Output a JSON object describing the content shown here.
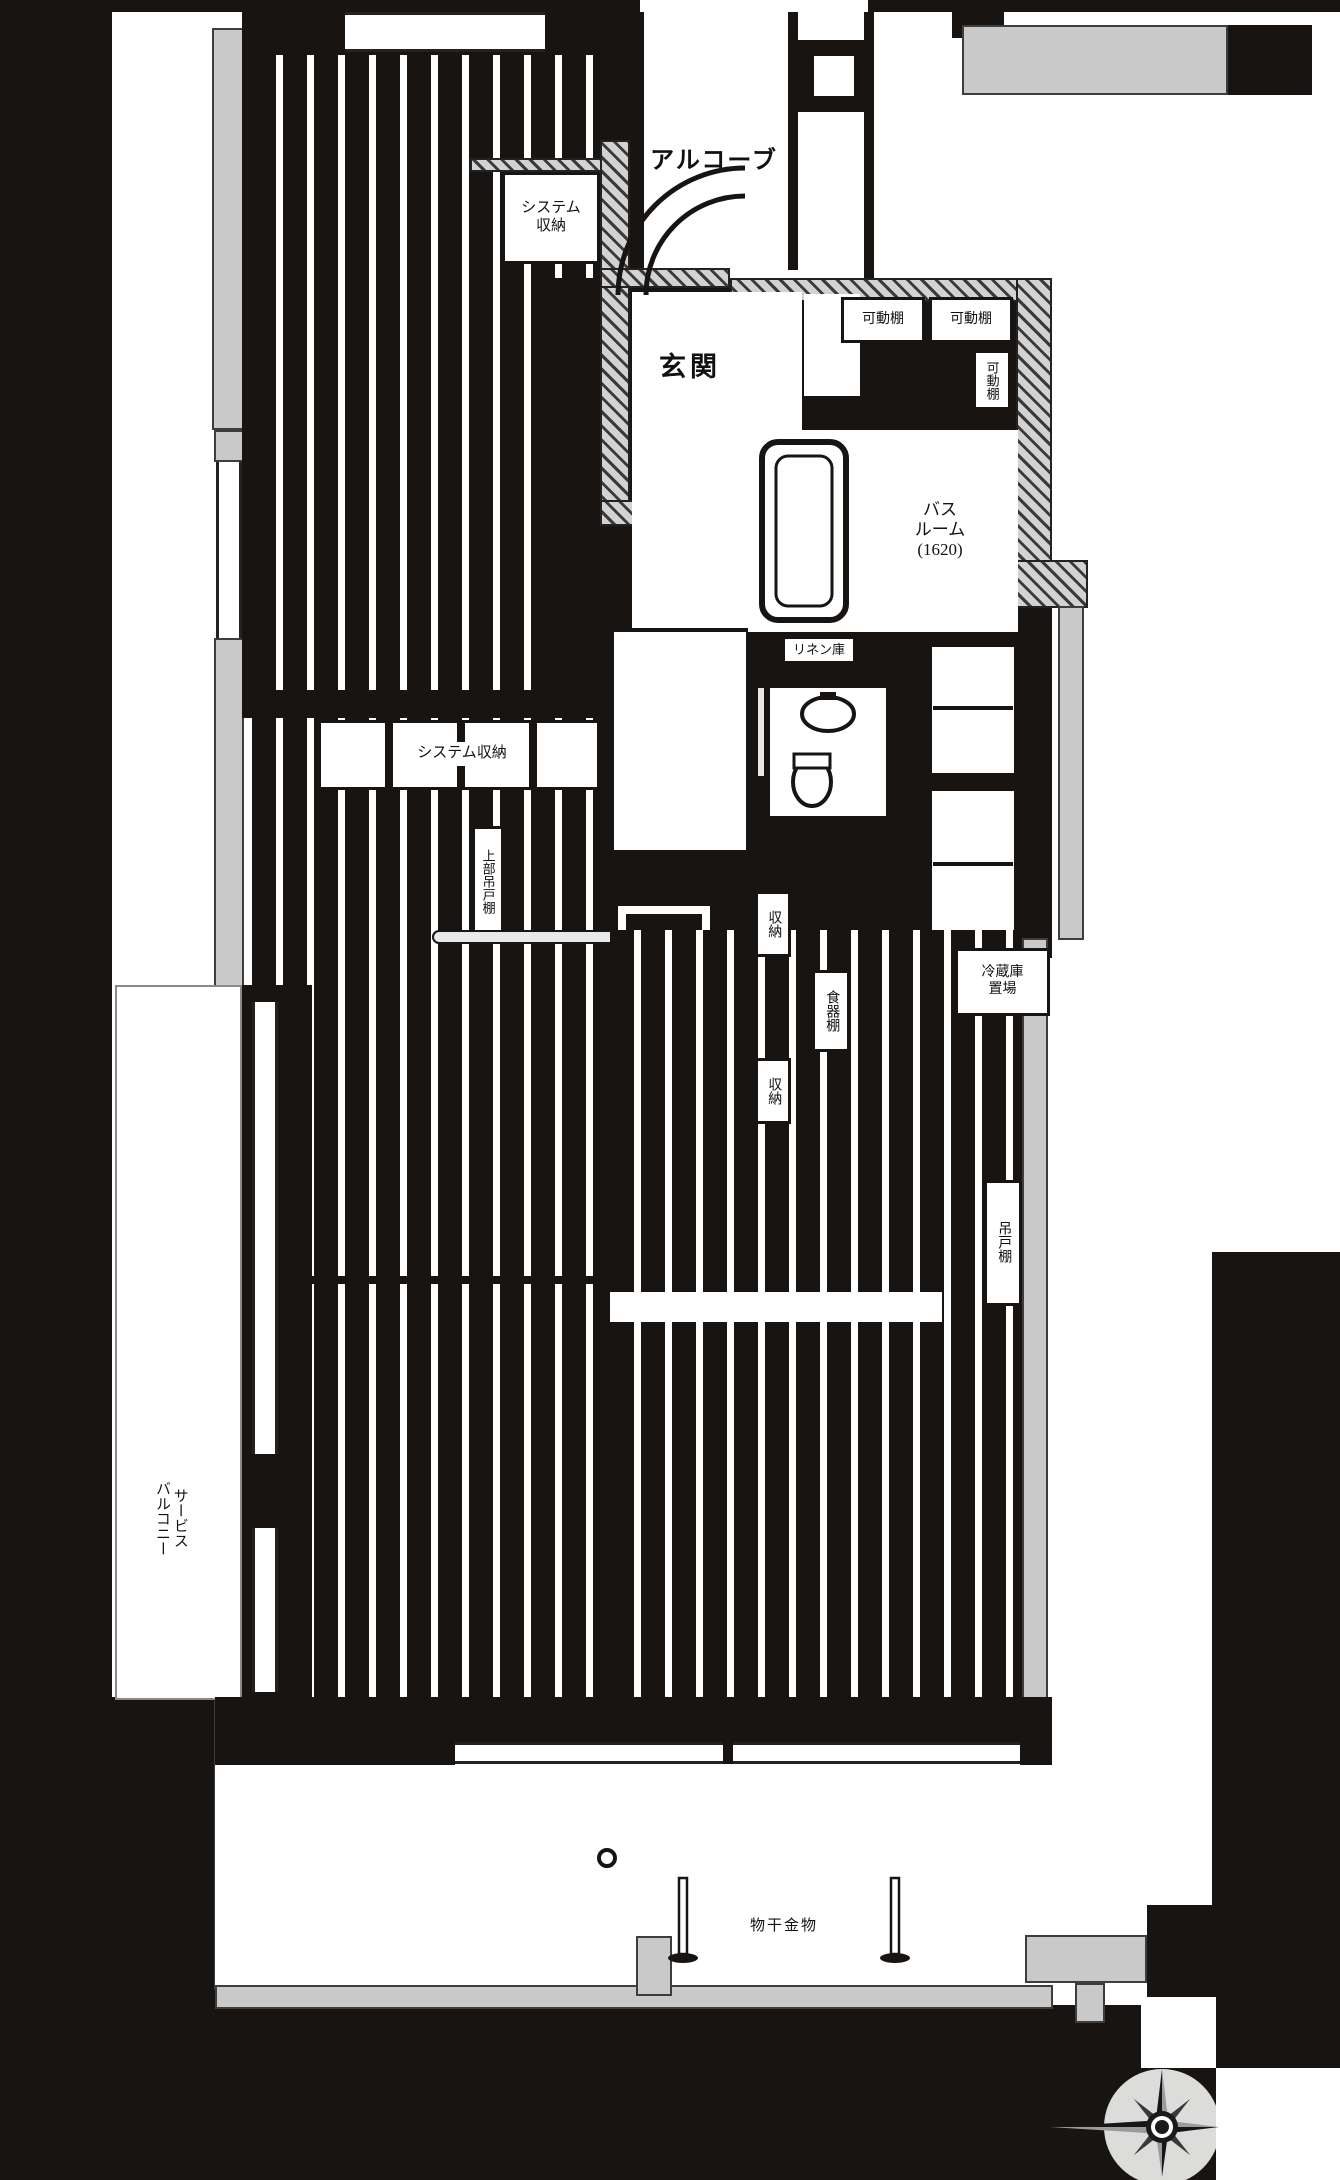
{
  "plan": {
    "type": "apartment-floor-plan",
    "colors": {
      "wall": "#181411",
      "slab_gray": "#c9c9c9",
      "floor_white": "#ffffff",
      "hatch_light": "#d2d2d2"
    },
    "labels": {
      "alcove": "アルコーブ",
      "system_storage_top": "システム\n収納",
      "entrance": "玄関",
      "movable_shelf_1": "可動棚",
      "movable_shelf_2": "可動棚",
      "movable_shelf_3": "可動棚",
      "bathroom": "バス\nルーム\n(1620)",
      "linen_closet": "リネン庫",
      "system_storage_mid": "システム収納",
      "upper_hanging_cabinet": "上部吊戸棚",
      "storage_upper": "収納",
      "dish_cabinet": "食器棚",
      "storage_lower": "収納",
      "refrigerator_space": "冷蔵庫\n置場",
      "hanging_cabinet": "吊戸棚",
      "service_balcony": "サービス\nバルコニー",
      "laundry_fitting": "物干金物"
    },
    "icons": {
      "compass": "compass-rose"
    }
  }
}
